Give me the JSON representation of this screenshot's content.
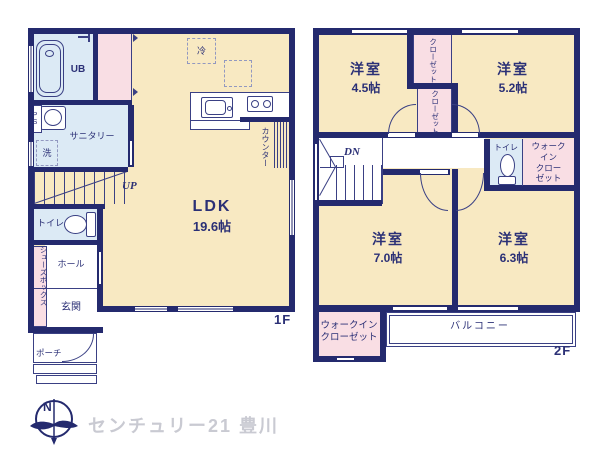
{
  "colors": {
    "wall": "#242a6e",
    "ink": "#2b3076",
    "cream": "#f8e9c2",
    "blue": "#dceaf5",
    "pink": "#f9dee4",
    "gray": "#c9cad2"
  },
  "floor1": {
    "floor_label": "1F",
    "rooms": {
      "ldk": {
        "name": "LDK",
        "size": "19.6帖"
      },
      "ub": "UB",
      "sanitary": "サニタリー",
      "wash": "洗",
      "ps": "PS",
      "fridge": "冷",
      "counter": "カウンター",
      "stairs": "UP",
      "toilet": "トイレ",
      "shoebox": "シューズボックス",
      "hall": "ホール",
      "entrance": "玄関",
      "porch": "ポーチ"
    }
  },
  "floor2": {
    "floor_label": "2F",
    "rooms": {
      "room_45": {
        "name": "洋室",
        "size": "4.5帖"
      },
      "room_52": {
        "name": "洋室",
        "size": "5.2帖"
      },
      "room_70": {
        "name": "洋室",
        "size": "7.0帖"
      },
      "room_63": {
        "name": "洋室",
        "size": "6.3帖"
      },
      "closet_a": "クローゼット",
      "closet_b": "クローゼット",
      "stairs": "DN",
      "toilet": "トイレ",
      "wic_side": "ウォーク\nイン\nクロー\nゼット",
      "wic_bottom": "ウォークイン\nクローゼット",
      "balcony": "バルコニー"
    }
  },
  "footer": {
    "compass_n": "N",
    "brand": "センチュリー21 豊川"
  }
}
